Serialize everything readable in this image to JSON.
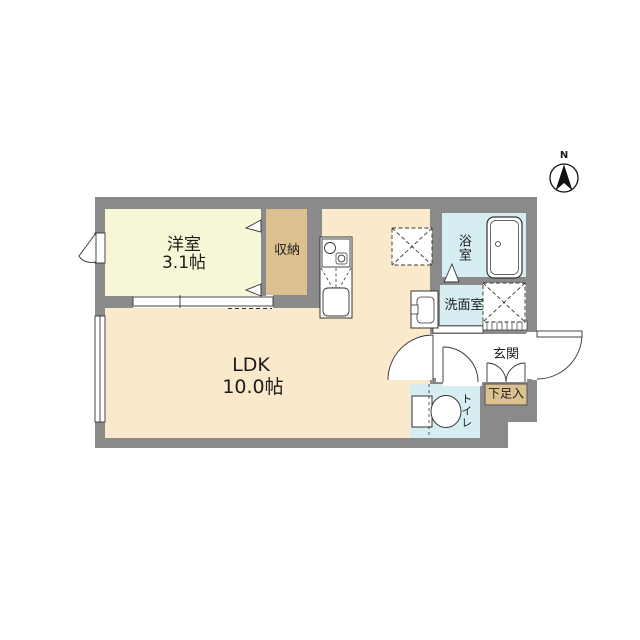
{
  "plan_title": "1LDK floor plan",
  "compass": {
    "north_label": "N"
  },
  "rooms": {
    "western_room": {
      "label": "洋室",
      "size": "3.1帖"
    },
    "ldk": {
      "label": "LDK",
      "size": "10.0帖"
    },
    "closet": {
      "label": "収納"
    },
    "bath": {
      "label": "浴室"
    },
    "washroom": {
      "label": "洗面室"
    },
    "entrance": {
      "label": "玄関"
    },
    "shoe_cabinet": {
      "label": "下足入"
    },
    "toilet": {
      "label": "トイレ"
    }
  },
  "colors": {
    "wall": "#8a8a8a",
    "western_room_floor": "#f7f7d7",
    "ldk_floor": "#faeacb",
    "closet_floor": "#dcc08f",
    "wet_area_floor": "#d6edf2",
    "line": "#333333"
  }
}
